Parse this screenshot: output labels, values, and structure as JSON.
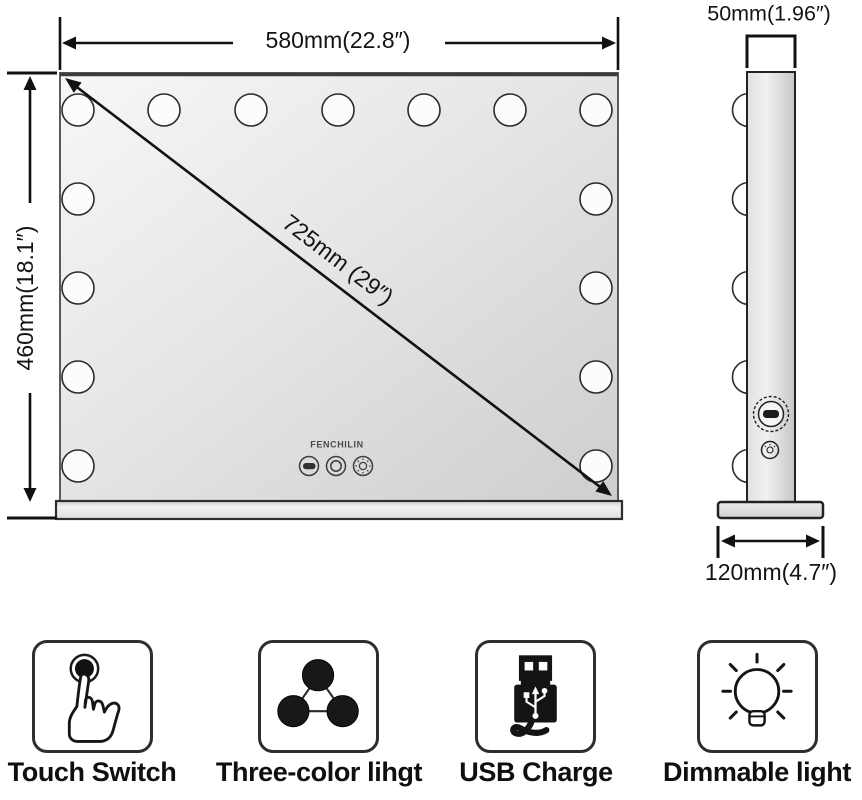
{
  "front_view": {
    "width_label": "580mm(22.8″)",
    "height_label": "460mm(18.1″)",
    "diagonal_label": "725mm (29″)",
    "brand": "FENCHILIN"
  },
  "side_view": {
    "depth_label": "50mm(1.96″)",
    "base_width_label": "120mm(4.7″)"
  },
  "features": [
    {
      "label": "Touch Switch",
      "icon": "touch-switch-icon"
    },
    {
      "label": "Three-color lihgt",
      "icon": "three-color-light-icon"
    },
    {
      "label": "USB Charge",
      "icon": "usb-charge-icon"
    },
    {
      "label": "Dimmable light",
      "icon": "dimmable-light-icon"
    }
  ],
  "colors": {
    "line": "#1a1a1a",
    "mirror_light": "#f6f6f6",
    "mirror_dark": "#cfcfcf",
    "icon_fill": "#181818"
  }
}
